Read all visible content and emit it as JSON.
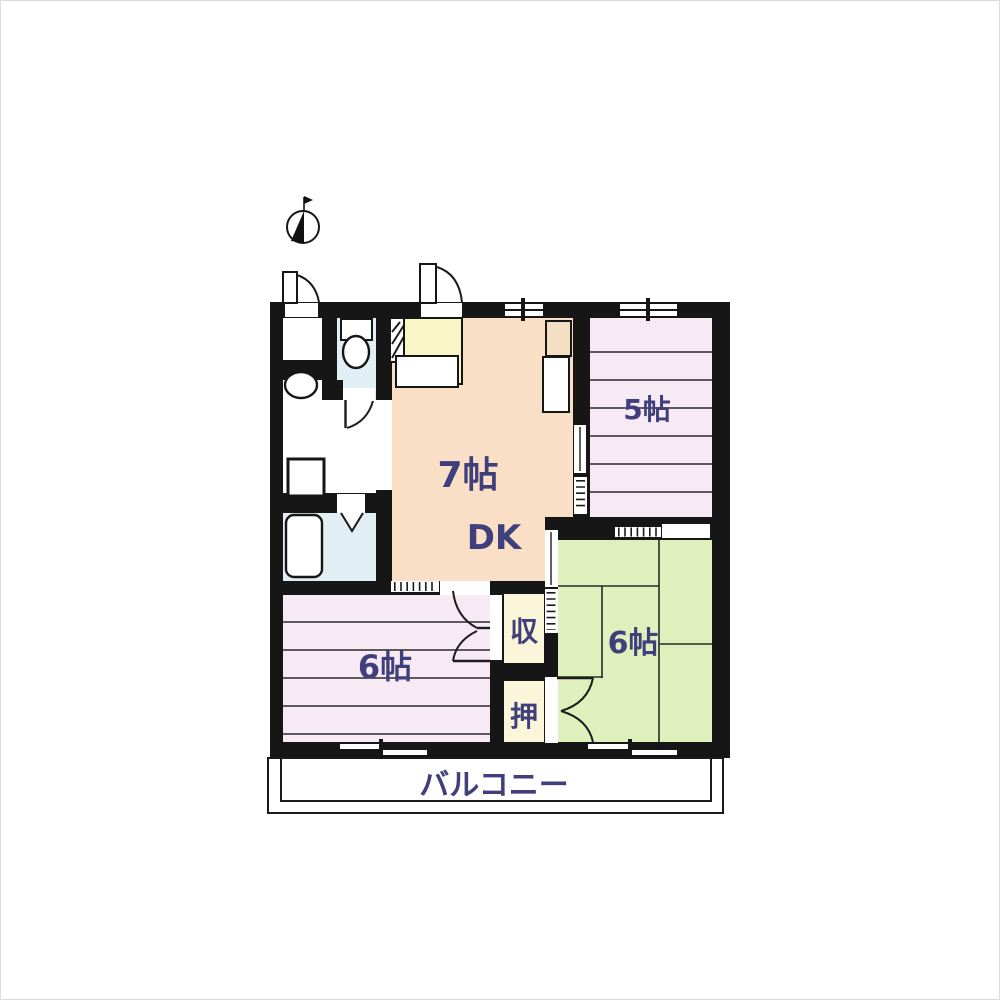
{
  "floor_plan": {
    "rooms": {
      "dk": {
        "size": "7帖",
        "type": "DK"
      },
      "bedroom_5": {
        "size": "5帖"
      },
      "tatami_6": {
        "size": "6帖"
      },
      "bedroom_6": {
        "size": "6帖"
      },
      "closet_top": {
        "label": "収"
      },
      "closet_bottom": {
        "label": "押"
      },
      "balcony": {
        "label": "バルコニー"
      }
    },
    "colors": {
      "wall": "#161616",
      "dk": "#f8dfc5",
      "kitchen": "#faf6c6",
      "bedroom": "#f8eaf5",
      "tatami": "#dff0bc",
      "closet": "#fbf6d9",
      "bath": "#e1eff5",
      "appliance": "#f3dfc2",
      "ink": "#3f3f7c"
    }
  }
}
